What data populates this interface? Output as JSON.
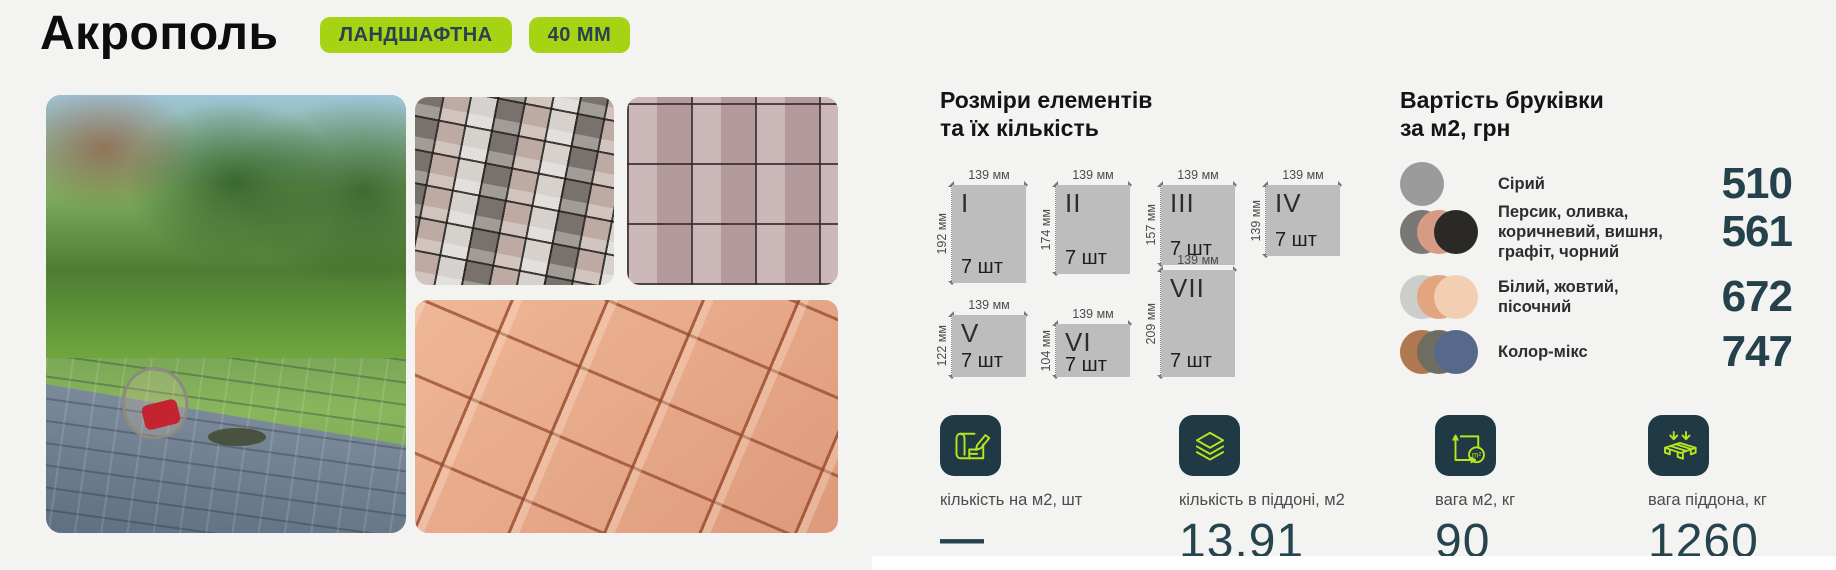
{
  "header": {
    "title": "Акрополь",
    "badges": [
      {
        "label": "ЛАНДШАФТНА"
      },
      {
        "label": "40 ММ"
      }
    ]
  },
  "photos": {
    "main": "garden-patio-photo",
    "sample_1": "gray-mix-paving-texture",
    "sample_2": "pink-paving-texture",
    "sample_3": "peach-paving-texture"
  },
  "sizes": {
    "heading": "Розміри елементів\nта їх кількість",
    "elements": [
      {
        "numeral": "I",
        "width": "139 мм",
        "height": "192 мм",
        "count": "7 шт"
      },
      {
        "numeral": "II",
        "width": "139 мм",
        "height": "174 мм",
        "count": "7 шт"
      },
      {
        "numeral": "III",
        "width": "139 мм",
        "height": "157 мм",
        "count": "7 шт"
      },
      {
        "numeral": "IV",
        "width": "139 мм",
        "height": "139 мм",
        "count": "7 шт"
      },
      {
        "numeral": "V",
        "width": "139 мм",
        "height": "122 мм",
        "count": "7 шт"
      },
      {
        "numeral": "VI",
        "width": "139 мм",
        "height": "104 мм",
        "count": "7 шт"
      },
      {
        "numeral": "VII",
        "width": "139 мм",
        "height": "209 мм",
        "count": "7 шт"
      }
    ]
  },
  "pricing": {
    "heading": "Вартість бруківки\nза м2, грн",
    "rows": [
      {
        "label": "Сірий",
        "price": "510",
        "swatches": [
          "#9b9b9b"
        ]
      },
      {
        "label": "Персик, оливка,\nкоричневий, вишня,\nграфіт, чорний",
        "price": "561",
        "swatches": [
          "#7a7877",
          "#d79a83",
          "#2b2927"
        ]
      },
      {
        "label": "Білий, жовтий,\nпісочний",
        "price": "672",
        "swatches": [
          "#cdcdcb",
          "#e2a57f",
          "#f2cfb3"
        ]
      },
      {
        "label": "Колор-мікс",
        "price": "747",
        "swatches": [
          "#b07851",
          "#6e6d62",
          "#57688a"
        ]
      }
    ]
  },
  "stats": [
    {
      "icon": "blueprint-pencil-icon",
      "label": "кількість на м2, шт",
      "value": "—"
    },
    {
      "icon": "layers-icon",
      "label": "кількість в піддоні, м2",
      "value": "13,91"
    },
    {
      "icon": "area-weight-icon",
      "label": "вага м2, кг",
      "value": "90"
    },
    {
      "icon": "pallet-weight-icon",
      "label": "вага піддона, кг",
      "value": "1260"
    }
  ],
  "colors": {
    "accent_lime": "#a6d414",
    "dark_teal": "#24414c",
    "icon_stroke": "#b7e41f",
    "element_box": "#bdbdbd",
    "background": "#f3f3f1"
  }
}
